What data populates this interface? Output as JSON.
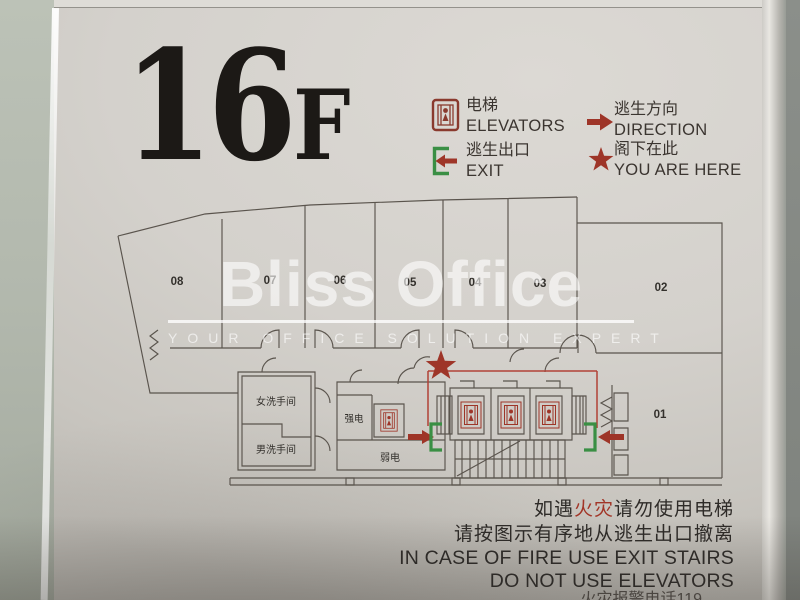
{
  "sign": {
    "floor_number": "16",
    "floor_suffix": "F",
    "legend": {
      "elevators": {
        "zh": "电梯",
        "en": "ELEVATORS"
      },
      "exit": {
        "zh": "逃生出口",
        "en": "EXIT"
      },
      "direction": {
        "zh": "逃生方向",
        "en": "DIRECTION"
      },
      "you_are_here": {
        "zh": "阁下在此",
        "en": "YOU ARE HERE"
      }
    },
    "floorplan": {
      "rooms": [
        "08",
        "07",
        "06",
        "05",
        "04",
        "03",
        "02",
        "01"
      ],
      "room_labels": {
        "women_restroom": "女洗手间",
        "men_restroom": "男洗手间",
        "strong_power": "强电",
        "weak_power": "弱电"
      }
    },
    "watermark": {
      "brand": "Bliss Office",
      "tagline": "YOUR OFFICE SOLUTION EXPERT"
    },
    "warnings": {
      "zh1_pre": "如遇",
      "zh1_red": "火灾",
      "zh1_post": "请勿使用电梯",
      "zh2": "请按图示有序地从逃生出口撤离",
      "en1": "IN CASE OF FIRE USE EXIT STAIRS",
      "en2": "DO NOT USE ELEVATORS",
      "cutoff": "火灾报警电话119"
    },
    "colors": {
      "accent_red": "#9e3528",
      "path_red": "#b14237",
      "exit_green": "#3a8f44",
      "plan_line": "#5a544d"
    }
  }
}
